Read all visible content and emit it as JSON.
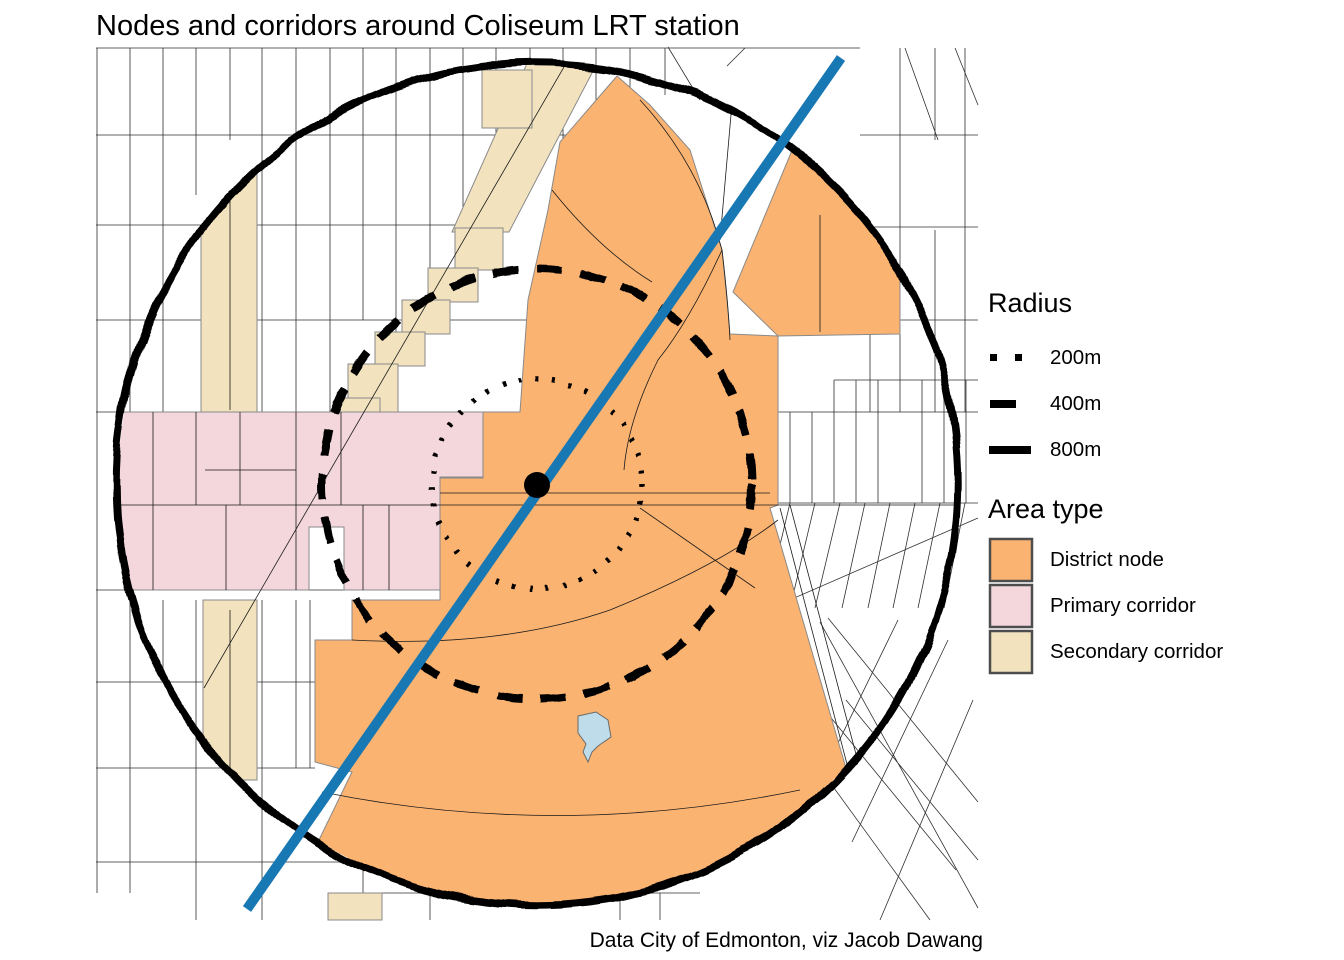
{
  "title": "Nodes and corridors around Coliseum LRT station",
  "caption": "Data City of Edmonton, viz Jacob Dawang",
  "legend": {
    "radius": {
      "title": "Radius",
      "items": [
        {
          "label": "200m",
          "style": "dotted"
        },
        {
          "label": "400m",
          "style": "dashed"
        },
        {
          "label": "800m",
          "style": "solid"
        }
      ]
    },
    "area_type": {
      "title": "Area type",
      "items": [
        {
          "label": "District node",
          "color": "#FBB371"
        },
        {
          "label": "Primary corridor",
          "color": "#F4D6DD"
        },
        {
          "label": "Secondary corridor",
          "color": "#F2E3BE"
        }
      ]
    }
  },
  "map": {
    "lrt_line_color": "#1878B4",
    "station_color": "#000000",
    "buffer_color": "#000000",
    "road_color": "#1A1A1A",
    "zone_outline_color": "#8A8A8A",
    "colors": {
      "district_node": "#FBB371",
      "primary_corridor": "#F4D6DD",
      "secondary_corridor": "#F2E3BE",
      "pond": "#BEDCE9"
    }
  }
}
